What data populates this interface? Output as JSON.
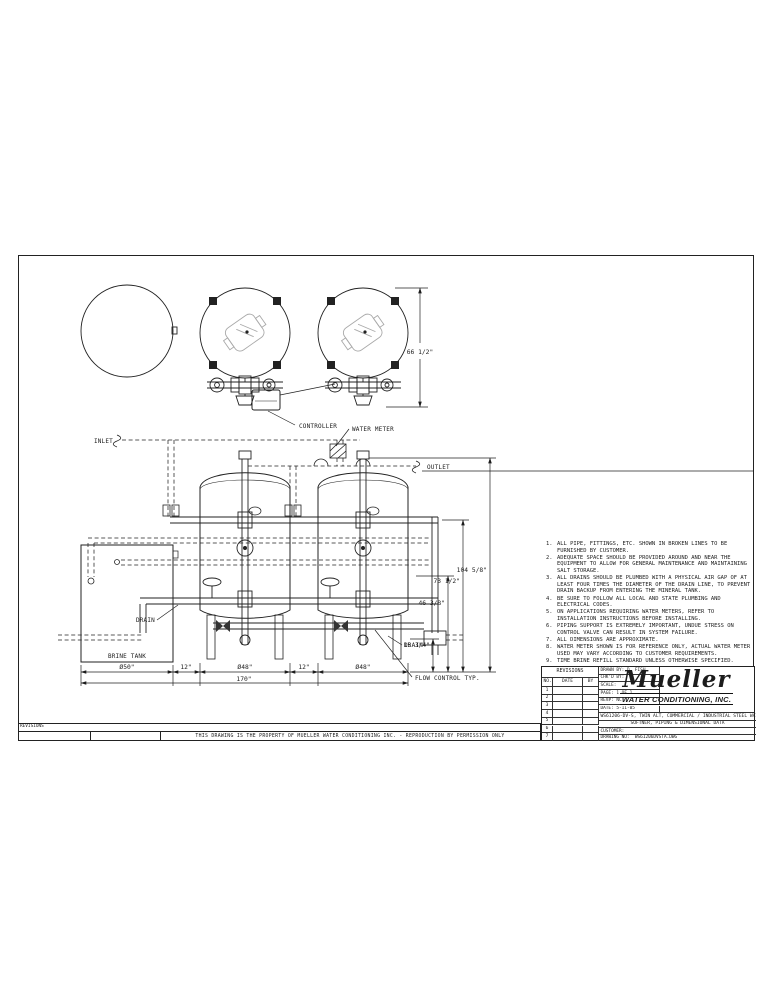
{
  "ink": "#1c1c1c",
  "page": {
    "property_notice": "THIS DRAWING IS THE PROPERTY OF MUELLER WATER CONDITIONING INC. - REPRODUCTION BY PERMISSION ONLY",
    "revisions_strip_label": "REVISIONS"
  },
  "drawing_labels": {
    "inlet": "INLET",
    "outlet": "OUTLET",
    "controller": "CONTROLLER",
    "water_meter": "WATER METER",
    "drain_left": "DRAIN",
    "drain_right": "DRAIN",
    "brine_tank": "BRINE TANK",
    "flow_control": "FLOW CONTROL TYP."
  },
  "dimensions": {
    "top_view_height": "66 1/2\"",
    "overall_height": "104 5/8\"",
    "inlet_height": "73 1/2\"",
    "mid_height": "46 3/8\"",
    "drain_height": "15 3/4\"",
    "brine_dia": "Ø50\"",
    "gap1": "12\"",
    "tank1_dia": "Ø48\"",
    "gap2": "12\"",
    "tank2_dia": "Ø48\"",
    "overall_width": "170\""
  },
  "notes": {
    "items": [
      {
        "num": "1.",
        "text": "ALL PIPE, FITTINGS, ETC. SHOWN IN BROKEN LINES TO BE FURNISHED BY CUSTOMER."
      },
      {
        "num": "2.",
        "text": "ADEQUATE SPACE SHOULD BE PROVIDED AROUND AND NEAR THE EQUIPMENT TO ALLOW FOR GENERAL MAINTENANCE AND MAINTAINING SALT STORAGE."
      },
      {
        "num": "3.",
        "text": "ALL DRAINS SHOULD BE PLUMBED WITH A PHYSICAL AIR GAP OF AT LEAST FOUR TIMES THE DIAMETER OF THE DRAIN LINE, TO PREVENT DRAIN BACKUP FROM ENTERING THE MINERAL TANK."
      },
      {
        "num": "4.",
        "text": "BE SURE TO FOLLOW ALL LOCAL AND STATE PLUMBING AND ELECTRICAL CODES."
      },
      {
        "num": "5.",
        "text": "ON APPLICATIONS REQUIRING WATER METERS, REFER TO INSTALLATION INSTRUCTIONS BEFORE INSTALLING."
      },
      {
        "num": "6.",
        "text": "PIPING SUPPORT IS EXTREMELY IMPORTANT, UNDUE STRESS ON CONTROL VALVE CAN RESULT IN SYSTEM FAILURE."
      },
      {
        "num": "7.",
        "text": "ALL DIMENSIONS ARE APPROXIMATE."
      },
      {
        "num": "8.",
        "text": "WATER METER SHOWN IS FOR REFERENCE ONLY, ACTUAL WATER METER USED MAY VARY ACCORDING TO CUSTOMER REQUIREMENTS."
      },
      {
        "num": "9.",
        "text": "TIME BRINE REFILL STANDARD UNLESS OTHERWISE SPECIFIED."
      }
    ]
  },
  "title_block": {
    "revisions": {
      "title": "REVISIONS",
      "col_no": "NO.",
      "col_date": "DATE",
      "col_by": "BY",
      "rows": [
        "1",
        "2",
        "3",
        "4",
        "5",
        "6",
        "7"
      ]
    },
    "drawn_by_label": "DRAWN BY:",
    "drawn_by": "D. FISH",
    "chkd_by_label": "CHK'D BY:",
    "scale_label": "SCALE:",
    "page_label": "PAGE:",
    "page": "1 OF 1",
    "rev_label": "REV#:",
    "rev": "NC",
    "date_label": "DATE:",
    "date": "5-11-05",
    "company_script": "Mueller",
    "company_name": "WATER CONDITIONING, INC.",
    "desc_line1": "WS61206-DV-S, TWIN ALT, COMMERCIAL / INDUSTRIAL STEEL WATER",
    "desc_line2": "SOFTNER, PIPING & DIMENSIONAL DATA",
    "customer_label": "CUSTOMER:",
    "drawing_no_label": "DRAWING NO:",
    "drawing_no": "WS61206DVSTA.DWG"
  }
}
